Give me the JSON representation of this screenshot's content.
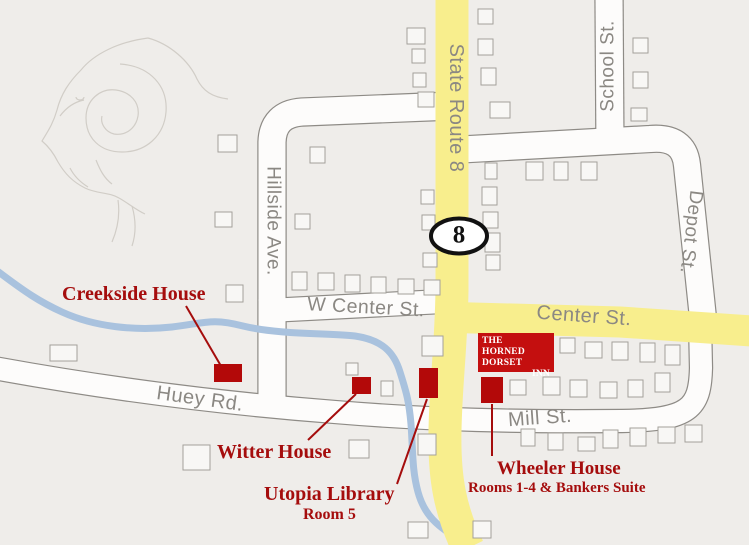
{
  "colors": {
    "background": "#EFEDEA",
    "road_fill": "#FDFCFB",
    "road_casing": "#8E8B86",
    "highway_yellow": "#F8EE8D",
    "creek_blue": "#A9C2DE",
    "house_fill": "#F8F7F5",
    "house_stroke": "#A3A09A",
    "landmark_red": "#B30909",
    "inn_red": "#C40F0F",
    "label_red": "#A50D0D",
    "label_gray": "#8B8883",
    "ram_sketch_gray": "#CCC8C1"
  },
  "roads": {
    "state_route_8": "State Route 8",
    "school_st": "School St.",
    "depot_st": "Depot St.",
    "hillside_ave": "Hillside Ave.",
    "w_center_st": "W Center St.",
    "center_st": "Center St.",
    "huey_rd": "Huey Rd.",
    "mill_st": "Mill St."
  },
  "shield": {
    "route_number": "8"
  },
  "inn": {
    "line1": "THE",
    "line2": "HORNED DORSET",
    "line3": "INN"
  },
  "landmarks": {
    "creekside": {
      "label": "Creekside House"
    },
    "witter": {
      "label": "Witter House"
    },
    "utopia": {
      "label": "Utopia Library",
      "sub": "Room 5"
    },
    "wheeler": {
      "label": "Wheeler House",
      "sub": "Rooms 1-4 & Bankers Suite"
    }
  },
  "map": {
    "width": 749,
    "height": 545,
    "road_paths": [
      {
        "d": "M 272,404 L 272,142 Q 273,114 302,112 L 452,106",
        "w": 27
      },
      {
        "d": "M 259,311 L 452,301",
        "w": 23
      },
      {
        "d": "M 609,-6 L 610,150",
        "w": 27
      },
      {
        "d": "M 452,150 L 650,139 Q 684,136 687,165 L 703,318",
        "w": 26
      },
      {
        "d": "M -6,368 C 120,391 230,404 335,412 C 430,420 520,422 622,421 C 690,420 700,408 701,368 L 700,322",
        "w": 22
      }
    ],
    "yellow_paths": [
      {
        "d": "M 452,-6 L 452,290 C 451,350 446,380 445,430 C 444,478 450,510 468,548",
        "w": 33
      },
      {
        "d": "M 437,317 L 620,322 L 752,331",
        "w": 31
      }
    ],
    "creek_path": "M -4,270 C 25,292 40,302 62,312 C 95,327 135,331 172,327 C 205,323 212,318 243,326 C 280,335 330,333 355,336 C 382,340 394,352 400,372 C 407,394 409,402 411,424 C 413,452 412,470 418,492 C 424,514 436,527 466,543",
    "houses": [
      [
        218,
        135,
        19,
        17
      ],
      [
        215,
        212,
        17,
        15
      ],
      [
        226,
        285,
        17,
        17
      ],
      [
        50,
        345,
        27,
        16
      ],
      [
        183,
        445,
        27,
        25
      ],
      [
        310,
        147,
        15,
        16
      ],
      [
        295,
        214,
        15,
        15
      ],
      [
        292,
        272,
        15,
        18
      ],
      [
        318,
        273,
        16,
        17
      ],
      [
        345,
        275,
        15,
        17
      ],
      [
        371,
        277,
        15,
        16
      ],
      [
        398,
        279,
        16,
        15
      ],
      [
        424,
        280,
        16,
        15
      ],
      [
        407,
        28,
        18,
        16
      ],
      [
        412,
        49,
        13,
        14
      ],
      [
        413,
        73,
        13,
        14
      ],
      [
        418,
        92,
        16,
        15
      ],
      [
        421,
        190,
        13,
        14
      ],
      [
        422,
        215,
        13,
        15
      ],
      [
        423,
        253,
        14,
        14
      ],
      [
        478,
        9,
        15,
        15
      ],
      [
        478,
        39,
        15,
        16
      ],
      [
        481,
        68,
        15,
        17
      ],
      [
        490,
        102,
        20,
        16
      ],
      [
        482,
        187,
        15,
        18
      ],
      [
        483,
        212,
        15,
        16
      ],
      [
        485,
        233,
        15,
        19
      ],
      [
        486,
        255,
        14,
        15
      ],
      [
        485,
        163,
        12,
        16
      ],
      [
        526,
        162,
        17,
        18
      ],
      [
        554,
        162,
        14,
        18
      ],
      [
        581,
        162,
        16,
        18
      ],
      [
        633,
        38,
        15,
        15
      ],
      [
        633,
        72,
        15,
        16
      ],
      [
        631,
        108,
        16,
        13
      ],
      [
        422,
        336,
        21,
        20
      ],
      [
        560,
        338,
        15,
        15
      ],
      [
        585,
        342,
        17,
        16
      ],
      [
        612,
        342,
        16,
        18
      ],
      [
        640,
        343,
        15,
        19
      ],
      [
        665,
        345,
        15,
        20
      ],
      [
        543,
        377,
        17,
        18
      ],
      [
        570,
        380,
        17,
        17
      ],
      [
        600,
        382,
        17,
        16
      ],
      [
        628,
        380,
        15,
        17
      ],
      [
        655,
        373,
        15,
        19
      ],
      [
        510,
        380,
        16,
        15
      ],
      [
        381,
        381,
        12,
        15
      ],
      [
        346,
        363,
        12,
        12
      ],
      [
        349,
        440,
        20,
        18
      ],
      [
        418,
        434,
        18,
        21
      ],
      [
        521,
        429,
        14,
        17
      ],
      [
        548,
        433,
        15,
        17
      ],
      [
        578,
        437,
        17,
        14
      ],
      [
        603,
        430,
        15,
        18
      ],
      [
        630,
        428,
        16,
        18
      ],
      [
        658,
        427,
        17,
        16
      ],
      [
        685,
        425,
        17,
        17
      ],
      [
        408,
        522,
        20,
        16
      ],
      [
        473,
        521,
        18,
        17
      ]
    ],
    "red_squares": {
      "creekside": [
        214,
        364,
        28,
        18
      ],
      "witter": [
        352,
        377,
        19,
        17
      ],
      "utopia": [
        419,
        368,
        19,
        30
      ],
      "wheeler": [
        481,
        377,
        22,
        26
      ]
    },
    "leader_lines": [
      [
        186,
        306,
        221,
        366
      ],
      [
        308,
        440,
        356,
        394
      ],
      [
        397,
        484,
        427,
        399
      ],
      [
        492,
        404,
        492,
        456
      ]
    ],
    "shield_ellipse": {
      "cx": 459,
      "cy": 236,
      "rx": 28,
      "ry": 17.5
    }
  }
}
